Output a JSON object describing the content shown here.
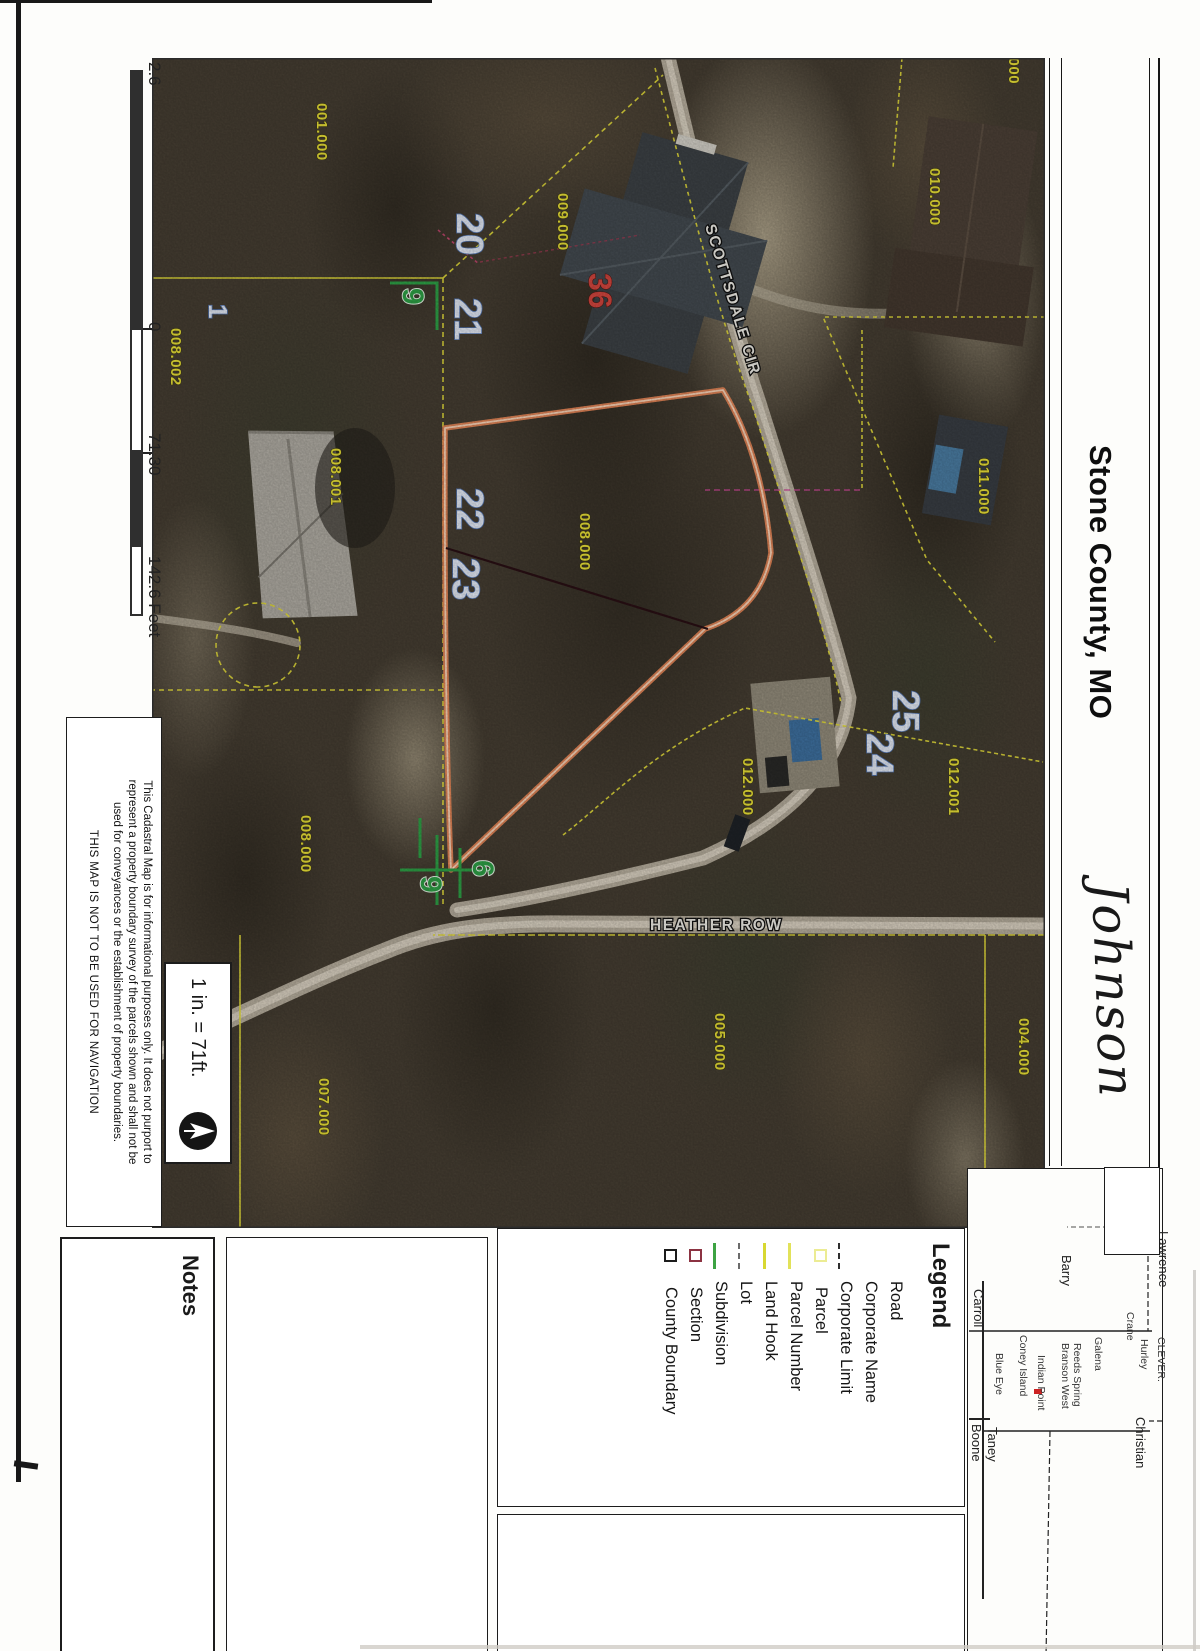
{
  "title": "Stone County, MO",
  "handwritten_name": "Johnson",
  "scale_box": {
    "text": "1 in. = 71ft.",
    "north_arrow_icon": "north-arrow"
  },
  "scalebar": {
    "label_left": "2.6",
    "label_zero": "0",
    "label_mid": "71.30",
    "label_right": "142.6 Feet"
  },
  "disclaimer": {
    "line1": "This Cadastral Map is for informational purposes only.  It does not purport to",
    "line2": "represent a property boundary survey of the parcels shown and shall not be",
    "line3": "used for conveyances or the establishment of property boundaries.",
    "line4": "THIS MAP IS NOT TO BE USED FOR NAVIGATION"
  },
  "notes": {
    "label": "Notes"
  },
  "legend": {
    "title": "Legend",
    "items": [
      {
        "label": "Road",
        "symbol": "none"
      },
      {
        "label": "Corporate Name",
        "symbol": "none"
      },
      {
        "label": "Corporate Limit",
        "symbol": "black-dashed-line"
      },
      {
        "label": "Parcel",
        "symbol": "yellow-square"
      },
      {
        "label": "Parcel Number",
        "symbol": "yellow-line"
      },
      {
        "label": "Land Hook",
        "symbol": "yellow-line"
      },
      {
        "label": "Lot",
        "symbol": "gray-dashed-line"
      },
      {
        "label": "Subdivision",
        "symbol": "green-line"
      },
      {
        "label": "Section",
        "symbol": "maroon-square"
      },
      {
        "label": "County Boundary",
        "symbol": "black-square"
      }
    ]
  },
  "inset": {
    "counties": {
      "lawrence": "Lawrence",
      "christian": "Christian",
      "barry": "Barry",
      "carroll": "Carroll",
      "taney": "Taney",
      "boone": "Boone"
    },
    "places": {
      "clever": "CLEVER.",
      "hurley": "Hurley",
      "crane": "Crane",
      "galena": "Galena",
      "reeds_spring": "Reeds Spring",
      "branson_west": "Branson West",
      "indian_point": "Indian Point",
      "coney_island": "Coney Island",
      "blue_eye": "Blue Eye"
    }
  },
  "map": {
    "streets": {
      "scottsdale": "SCOTTSDALE CIR",
      "heather": "HEATHER ROW"
    },
    "section_number": "36",
    "parcel_labels": {
      "p9000": "9.000",
      "p001000": "001.000",
      "p009000": "009.000",
      "p010000": "010.000",
      "p011000": "011.000",
      "p008002": "008.002",
      "p008001": "008.001",
      "p008000a": "008.000",
      "p008000b": "008.000",
      "p012000": "012.000",
      "p012001": "012.001",
      "p007000": "007.000",
      "p005000": "005.000",
      "p004000": "004.000"
    },
    "lot_numbers": {
      "l1": "1",
      "l20": "20",
      "l21": "21",
      "l22": "22",
      "l23": "23",
      "l24": "24",
      "l25": "25"
    },
    "land_hook_numbers": {
      "h9a": "9",
      "h9b": "9",
      "h6": "6"
    }
  },
  "colors": {
    "parcel_line": "#e8e03c",
    "highlight_parcel": "#ed8a5a",
    "parcel_label_text": "#efe63a",
    "lot_number_text": "#e7eefb",
    "section_text": "#d84840",
    "land_hook_green": "#2fa548",
    "street_label_text": "#f7f5ee"
  }
}
